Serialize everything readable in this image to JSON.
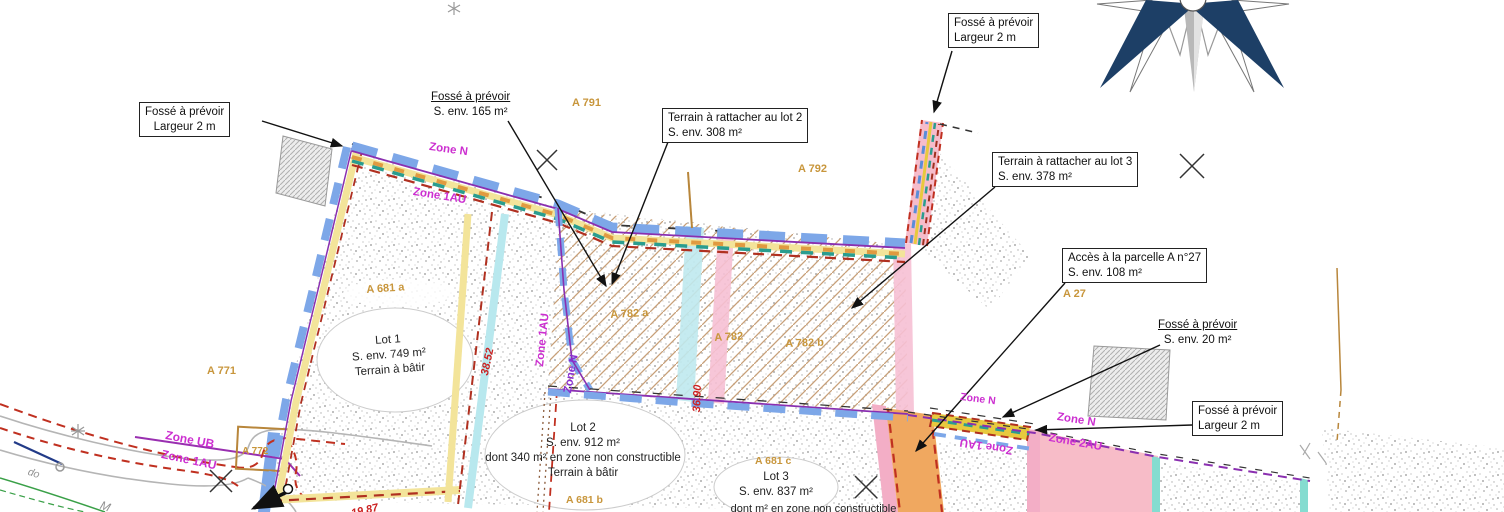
{
  "plan": {
    "callouts": {
      "fosse_left": {
        "line1": "Fossé à prévoir",
        "line2": "Largeur 2 m"
      },
      "fosse_165": {
        "line1": "Fossé à prévoir",
        "line2": "S. env. 165 m²"
      },
      "terrain_lot2": {
        "line1": "Terrain à rattacher au lot 2",
        "line2": "S. env. 308 m²"
      },
      "fosse_top": {
        "line1": "Fossé à prévoir",
        "line2": "Largeur 2 m"
      },
      "terrain_lot3": {
        "line1": "Terrain à rattacher au lot 3",
        "line2": "S. env. 378 m²"
      },
      "acces_a27": {
        "line1": "Accès à la parcelle A n°27",
        "line2": "S. env. 108 m²"
      },
      "fosse_20": {
        "line1": "Fossé à prévoir",
        "line2": "S. env. 20 m²"
      },
      "fosse_right": {
        "line1": "Fossé à prévoir",
        "line2": "Largeur 2 m"
      }
    },
    "parcels": {
      "a771": "A 771",
      "a772": "A 772",
      "a791": "A 791",
      "a792": "A 792",
      "a27": "A 27",
      "a681a": "A 681 a",
      "a681b": "A 681 b",
      "a681c": "A 681 c",
      "a782a": "A 782 a",
      "a782": "A 782",
      "a782b": "A 782 b"
    },
    "zones": {
      "n_top": "Zone N",
      "au1_top": "Zone 1AU",
      "ub": "Zone UB",
      "au1_road": "Zone 1AU",
      "au1_mid": "Zone 1AU",
      "n_mid": "Zone N",
      "n_small": "Zone N",
      "n_right": "Zone N",
      "au2_right": "Zone 2AU",
      "au1_flip": "Zone 1AU"
    },
    "lots": {
      "lot1": {
        "title": "Lot 1",
        "area": "S. env. 749 m²",
        "note": "Terrain à bâtir"
      },
      "lot2": {
        "title": "Lot 2",
        "area": "S. env. 912 m²",
        "note1": "dont 340 m² en zone non constructible",
        "note2": "Terrain à bâtir"
      },
      "lot3": {
        "title": "Lot 3",
        "area": "S. env. 837 m²",
        "note_clipped": "dont m² en zone non constructible"
      }
    },
    "measurements": {
      "d1": "38.52",
      "d2": "36.90",
      "d3": "19.87"
    },
    "road_text": {
      "t1": "do",
      "t2": "M"
    },
    "colors": {
      "zone_label": "#cc2fd0",
      "parcel_label": "#c8963c",
      "measure": "#cc2222",
      "band_blue": "#7da7e8",
      "band_yellow": "#f3e49a",
      "band_teal": "#2a9d8f",
      "band_darkred": "#b03020",
      "fill_orange": "#f0a860",
      "fill_pink": "#f7bcc8",
      "fill_cyan": "#bfe9ee",
      "compass_navy": "#1d3f66"
    }
  }
}
